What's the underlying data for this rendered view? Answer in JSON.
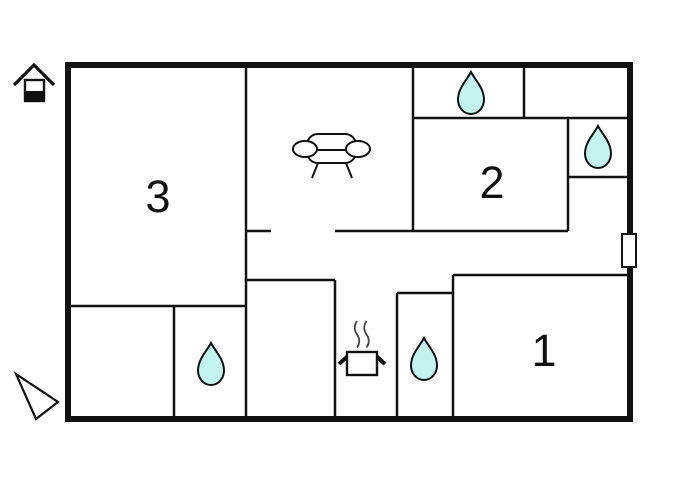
{
  "plan": {
    "type": "floor-plan",
    "room_labels": [
      {
        "id": "room-1",
        "label": "1"
      },
      {
        "id": "room-2",
        "label": "2"
      },
      {
        "id": "room-3",
        "label": "3"
      }
    ],
    "icons": {
      "house": "house-icon",
      "pointer": "triangle-pointer-icon",
      "sofa": "sofa-icon",
      "stove": "stove-pot-icon",
      "water_drop": "water-drop-icon",
      "water_drop_count": 4,
      "door_marker": "door-window-marker"
    },
    "colors": {
      "wall": "#111111",
      "background": "#ffffff",
      "water_drop_fill": "#c3f3ef",
      "steam": "#444444"
    }
  }
}
